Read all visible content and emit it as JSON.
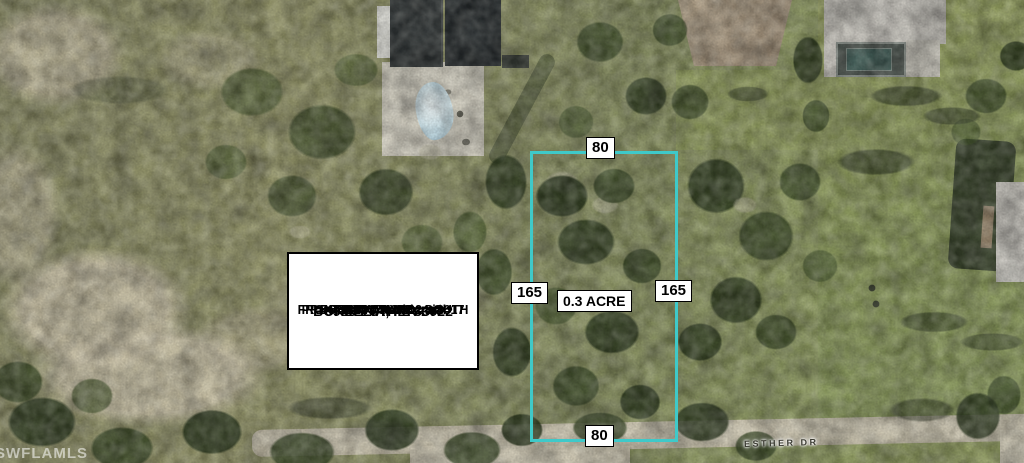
{
  "watermark": "SWFLAMLS",
  "street": {
    "name": "ESTHER DR"
  },
  "parcel": {
    "outline_color": "#3FC9C9",
    "labels": {
      "top_width": "80",
      "bottom_width": "80",
      "left_depth": "165",
      "right_depth": "165",
      "area": "0.3 ACRE"
    }
  },
  "info_box": {
    "address_line1": "5986 ESTHER DR",
    "address_line2": "BOKEELIA, FL 33922",
    "divider": "=========================",
    "line_tax": "PROPERTY TAX 2024: $617",
    "line_exposure": "FRONT EXPOSURE:  SOUTH",
    "line_zoning": "ZONING:  Residential",
    "line_hoa": "NO HOA"
  }
}
